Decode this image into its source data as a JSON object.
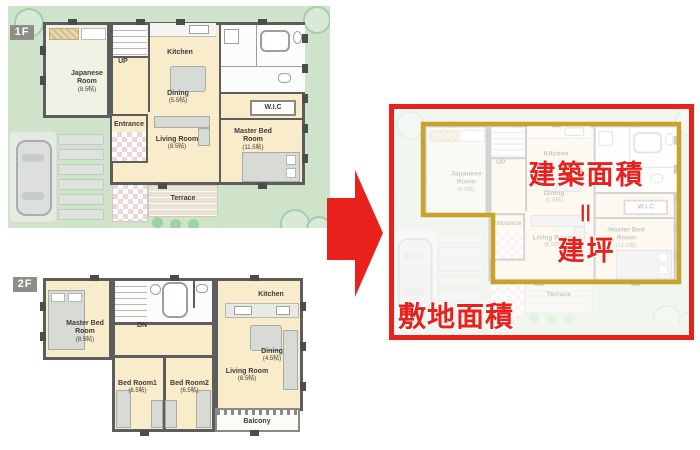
{
  "colors": {
    "red": "#e8211d",
    "gold": "#c9a227",
    "lawn": "#cfe3cb",
    "wall": "#5d5d5d",
    "room_cream": "#f8ecca",
    "badge_gray": "#8e8e88"
  },
  "icons": {
    "arrow": "arrow-right",
    "tree": "tree",
    "bush": "bush",
    "car": "car"
  },
  "f1": {
    "badge": "1F",
    "japanese": {
      "name": "Japanese Room",
      "size": "(8.5帖)"
    },
    "up": "UP",
    "kitchen": "Kitchen",
    "dining": {
      "name": "Dining",
      "size": "(5.5帖)"
    },
    "wic": "W.I.C",
    "entrance": "Entrance",
    "living": {
      "name": "Living Room",
      "size": "(8.5帖)"
    },
    "master": {
      "name": "Master Bed Room",
      "size": "(11.5帖)"
    },
    "terrace": "Terrace"
  },
  "f2": {
    "badge": "2F",
    "master": {
      "name": "Master Bed Room",
      "size": "(8.5帖)"
    },
    "dn": "DN",
    "kitchen": "Kitchen",
    "dining": {
      "name": "Dining",
      "size": "(4.5帖)"
    },
    "bed1": {
      "name": "Bed Room1",
      "size": "(6.5帖)"
    },
    "bed2": {
      "name": "Bed Room2",
      "size": "(6.5帖)"
    },
    "living": {
      "name": "Living Room",
      "size": "(8.5帖)"
    },
    "balcony": "Balcony"
  },
  "result": {
    "building_area": "建築面積",
    "equals": "＝",
    "tsubo": "建坪",
    "site_area": "敷地面積"
  }
}
